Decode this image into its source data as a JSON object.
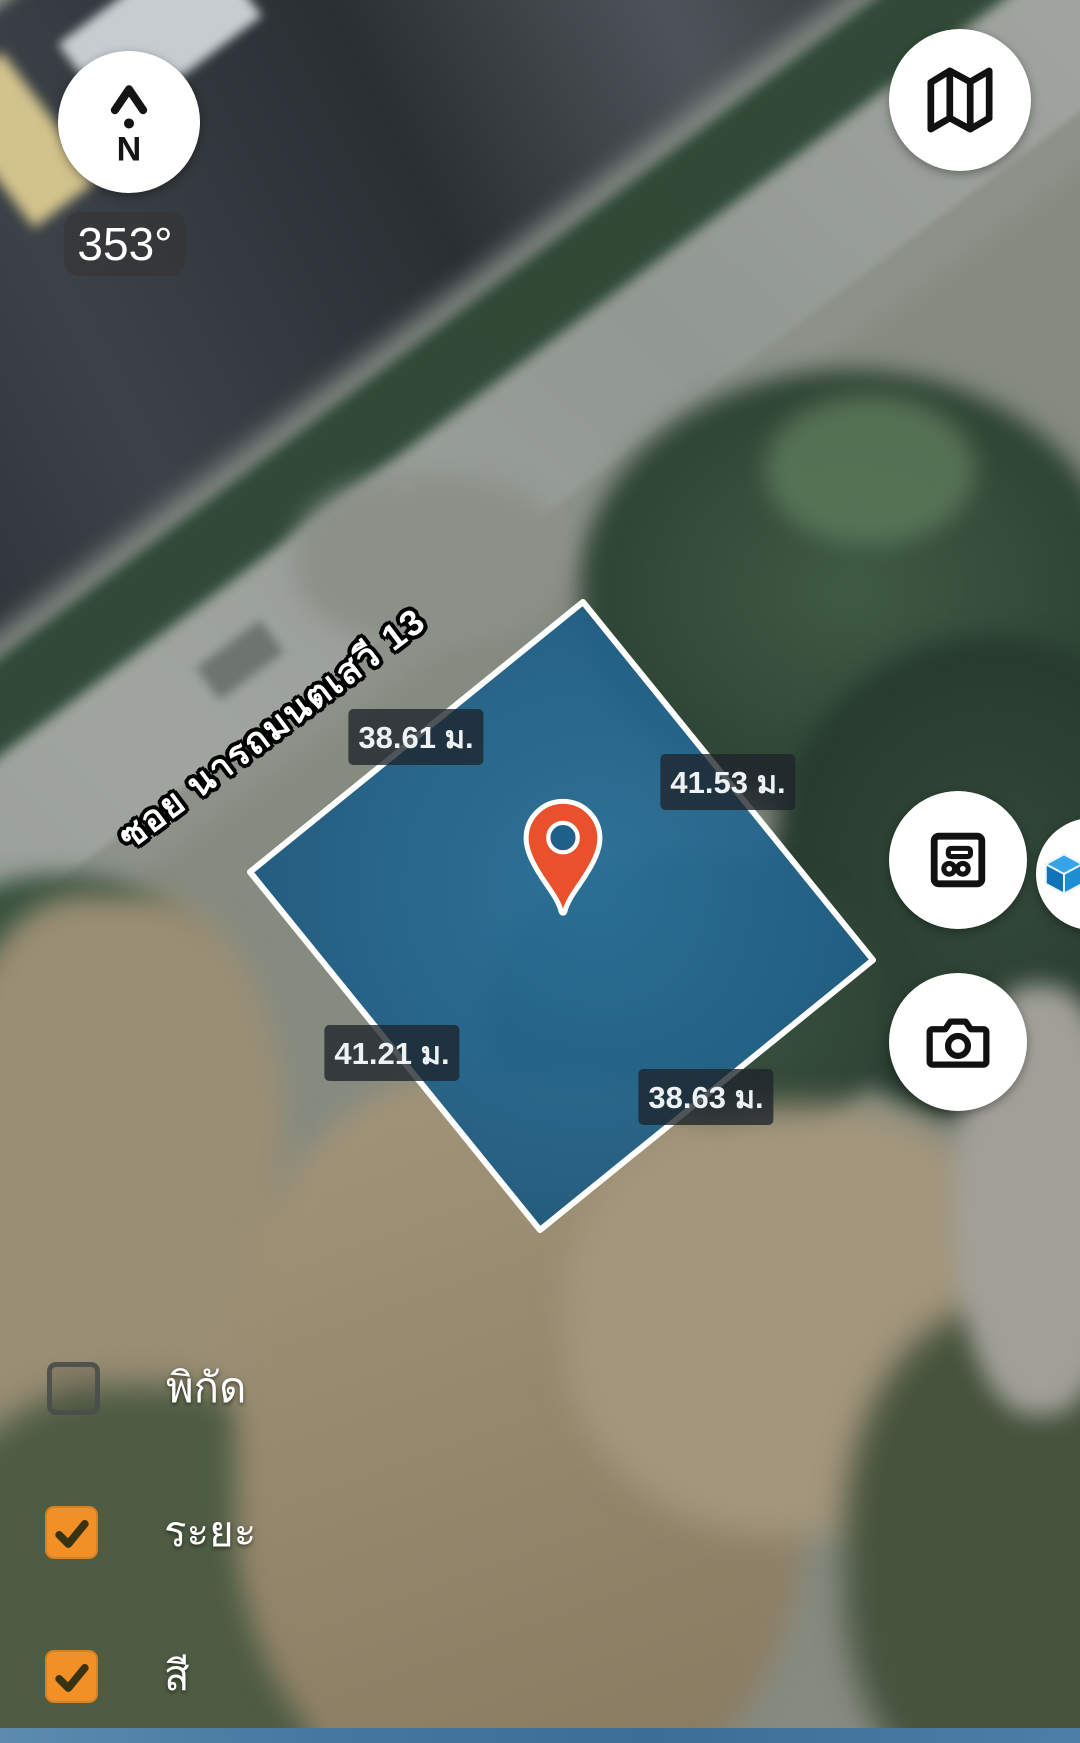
{
  "compass": {
    "heading": "353°",
    "north_label": "N",
    "arrow_icon": "north-chevron-icon"
  },
  "street": {
    "name": "ซอย นารถมนตเสวี 13"
  },
  "plot": {
    "fill_color": "#226288",
    "border_color": "#ffffff",
    "measurements": {
      "north_west": "38.61 ม.",
      "north_east": "41.53 ม.",
      "south_west": "41.21 ม.",
      "south_east": "38.63 ม."
    }
  },
  "pin": {
    "icon": "location-pin-icon",
    "color": "#e8512b"
  },
  "buttons": {
    "map": {
      "icon": "map-icon"
    },
    "floor_plan": {
      "icon": "floor-plan-icon"
    },
    "camera": {
      "icon": "camera-icon"
    },
    "cube_3d": {
      "icon": "cube-3d-icon"
    }
  },
  "layers": {
    "checkbox_color": "#f09026",
    "items": [
      {
        "label": "พิกัด",
        "checked": false
      },
      {
        "label": "ระยะ",
        "checked": true
      },
      {
        "label": "สี",
        "checked": true
      }
    ]
  }
}
